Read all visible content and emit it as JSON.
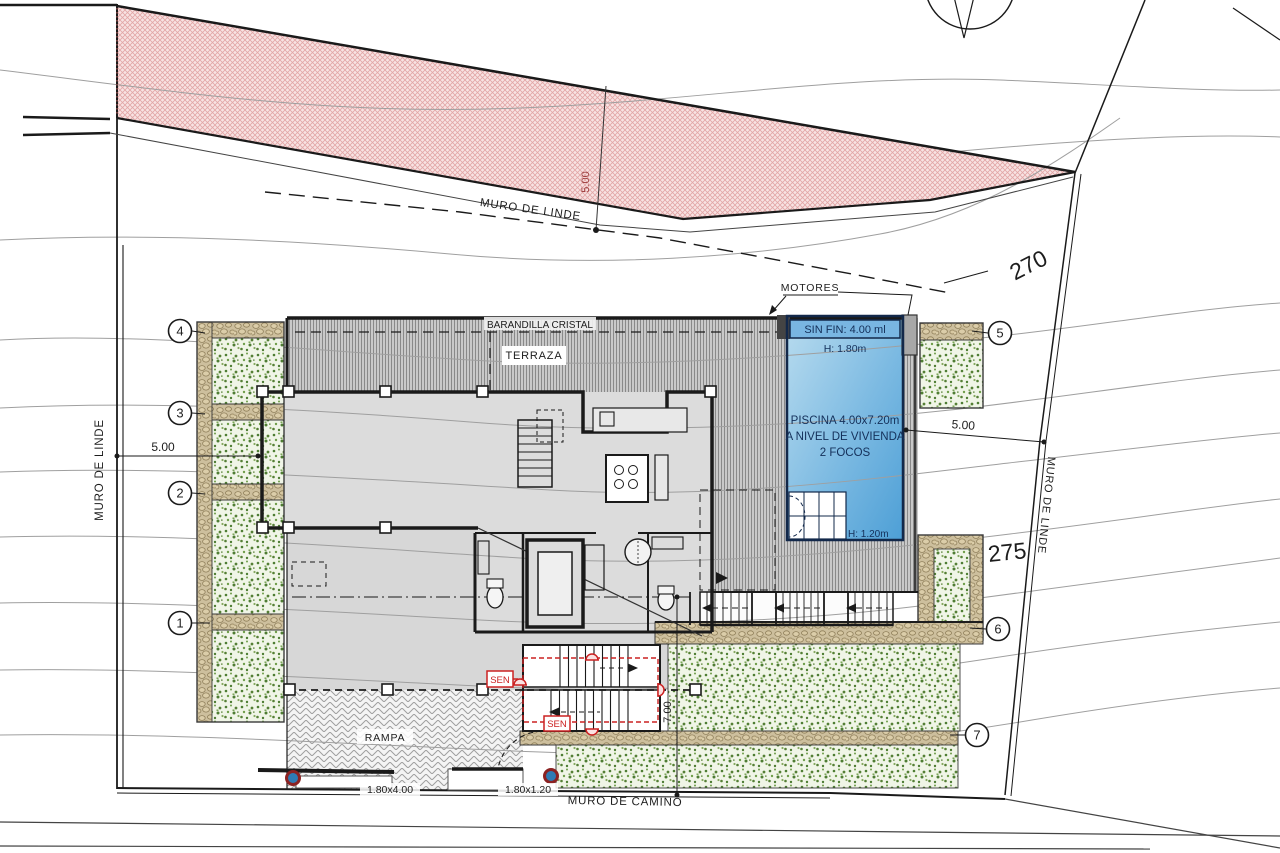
{
  "boundaries": {
    "muro_linde_top": "MURO DE LINDE",
    "muro_linde_left": "MURO DE LINDE",
    "muro_linde_right": "MURO DE LINDE",
    "muro_camino": "MURO DE CAMINO"
  },
  "contour_labels": {
    "c270": "270",
    "c275": "275"
  },
  "building": {
    "terraza": "TERRAZA",
    "barandilla": "BARANDILLA CRISTAL",
    "motores": "MOTORES",
    "rampa": "RAMPA"
  },
  "pool": {
    "name": "PISCINA 4.00x7.20m",
    "level": "A NIVEL DE VIVIENDA",
    "lights": "2 FOCOS",
    "edge": "SIN FIN: 4.00 ml",
    "depth_main": "H: 1.80m",
    "depth_steps": "H: 1.20m"
  },
  "dimensions": {
    "setback_top": "5.00",
    "setback_left": "5.00",
    "setback_right": "5.00",
    "drop_stairs": "7.00",
    "gate_main": "1.80x4.00",
    "gate_side": "1.80x1.20"
  },
  "annotations": {
    "sensor": "SEN"
  },
  "markers": [
    "1",
    "2",
    "3",
    "4",
    "5",
    "6",
    "7"
  ],
  "colors": {
    "pool_blue": "#4d9fd6",
    "pool_light": "#b9dcef",
    "setback_pink": "#f3d4d4",
    "vegetation_green": "#5f8f3f",
    "stone_tan": "#d8c9a4",
    "annotation_red": "#cc2222",
    "text_navy": "#14305a"
  }
}
